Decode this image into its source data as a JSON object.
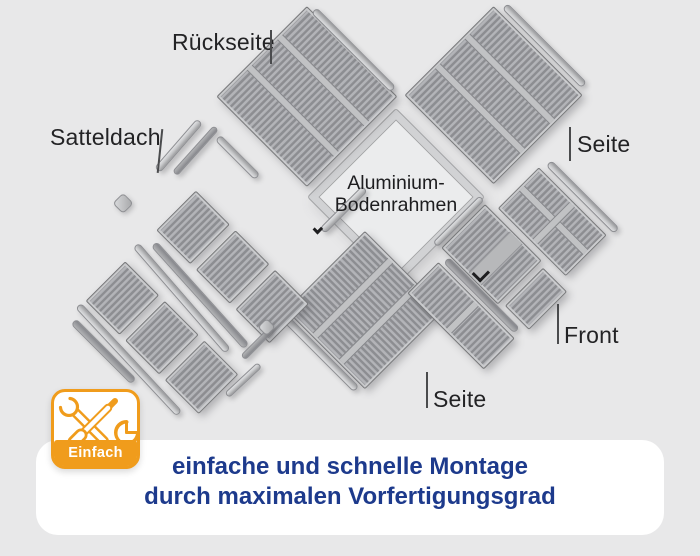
{
  "illustration": {
    "labels": {
      "back_panel": "Rückseite",
      "roof": "Satteldach",
      "floor_frame_line1": "Aluminium-",
      "floor_frame_line2": "Bodenrahmen",
      "side_right": "Seite",
      "front": "Front",
      "side_bottom": "Seite"
    },
    "parts": [
      "gable-roof-panels",
      "back-wall-panel",
      "right-side-panel",
      "left-side-panel",
      "front-panels-with-door",
      "aluminium-floor-frame",
      "profile-rails"
    ]
  },
  "badge": {
    "label": "Einfach",
    "icons": [
      "wrench-screwdriver-icon",
      "pie-clock-icon"
    ],
    "accent_color": "#F09C1C"
  },
  "caption": {
    "line1": "einfache und schnelle Montage",
    "line2": "durch maximalen Vorfertigungsgrad",
    "text_color": "#1D3A8C"
  },
  "colors": {
    "background": "#E8E8E9",
    "panel_gray": "#A9AAAE",
    "rail_gray": "#C7C8CA",
    "card_white": "#FFFFFF",
    "label_black": "#232325"
  }
}
